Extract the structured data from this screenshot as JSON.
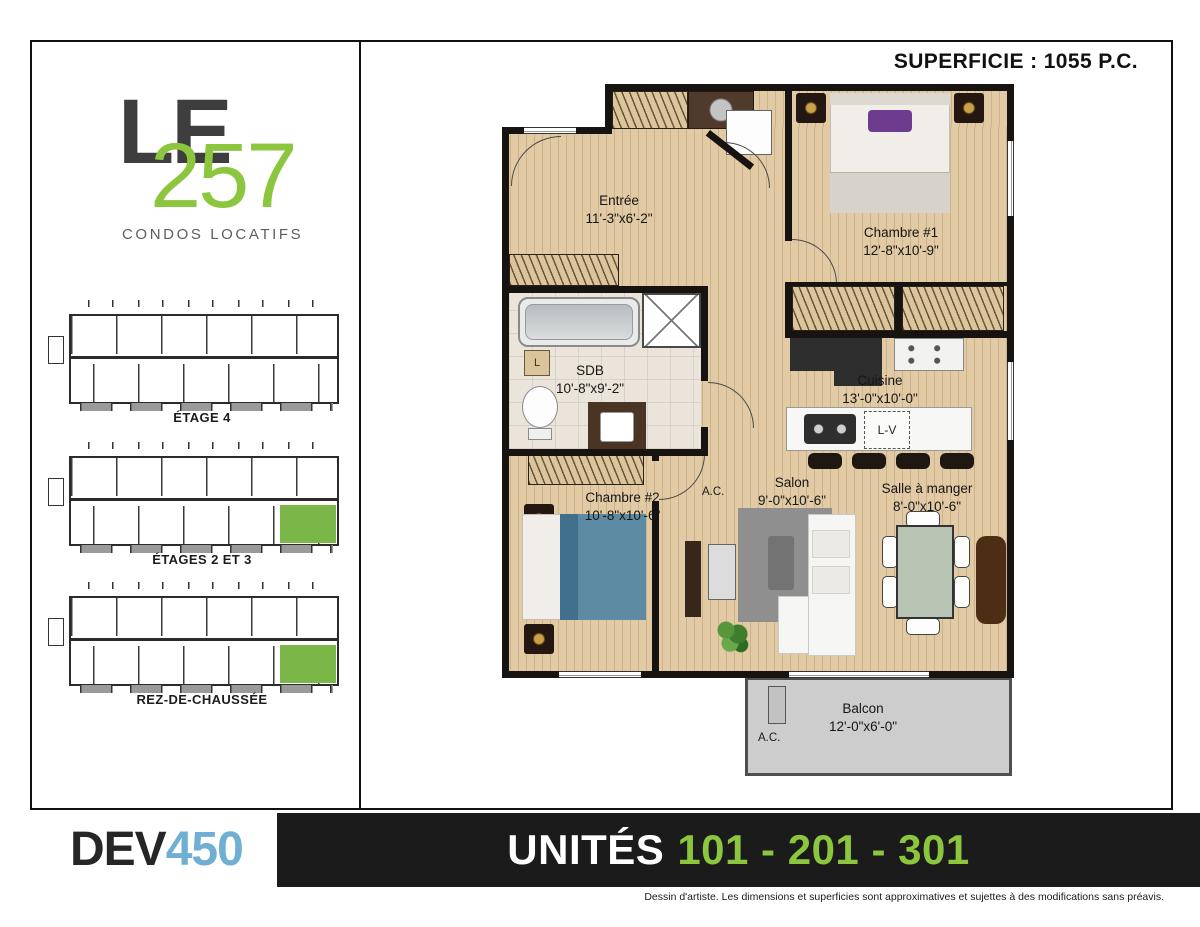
{
  "colors": {
    "green": "#8cc63f",
    "highlight_green": "#7ab648",
    "blue": "#6fafd3",
    "banner_bg": "#1b1b1b",
    "wall": "#171310",
    "wood": "#e2cba4",
    "tile": "#ebe4da",
    "balcony": "#cdcdcd",
    "bed_blue": "#5d8ba3"
  },
  "header": {
    "superficie": "SUPERFICIE : 1055 P.C."
  },
  "sidebar": {
    "logo": {
      "le": "LE",
      "number": "257",
      "subtitle": "CONDOS LOCATIFS"
    },
    "mini_plans": [
      {
        "caption": "ÉTAGE 4",
        "highlight": false
      },
      {
        "caption": "ÉTAGES 2 ET 3",
        "highlight": true
      },
      {
        "caption": "REZ-DE-CHAUSSÉE",
        "highlight": true
      }
    ]
  },
  "floorplan": {
    "rooms": [
      {
        "name": "Entrée",
        "dims": "11'-3\"x6'-2\""
      },
      {
        "name": "Chambre #1",
        "dims": "12'-8\"x10'-9\""
      },
      {
        "name": "SDB",
        "dims": "10'-8\"x9'-2\""
      },
      {
        "name": "Cuisine",
        "dims": "13'-0\"x10'-0\""
      },
      {
        "name": "Chambre #2",
        "dims": "10'-8\"x10'-6\""
      },
      {
        "name": "Salon",
        "dims": "9'-0\"x10'-6\""
      },
      {
        "name": "Salle à manger",
        "dims": "8'-0\"x10'-6\""
      },
      {
        "name": "Balcon",
        "dims": "12'-0\"x6'-0\""
      }
    ],
    "labels": {
      "ac_hall": "A.C.",
      "ac_balcony": "A.C.",
      "lv": "L-V",
      "linen": "L"
    }
  },
  "footer": {
    "logo": {
      "part1": "DEV",
      "part2": "450"
    },
    "banner": {
      "prefix": "UNITÉS",
      "units": "101 - 201 - 301"
    },
    "disclaimer": "Dessin d'artiste. Les dimensions et superficies sont approximatives et sujettes à des modifications sans préavis."
  }
}
